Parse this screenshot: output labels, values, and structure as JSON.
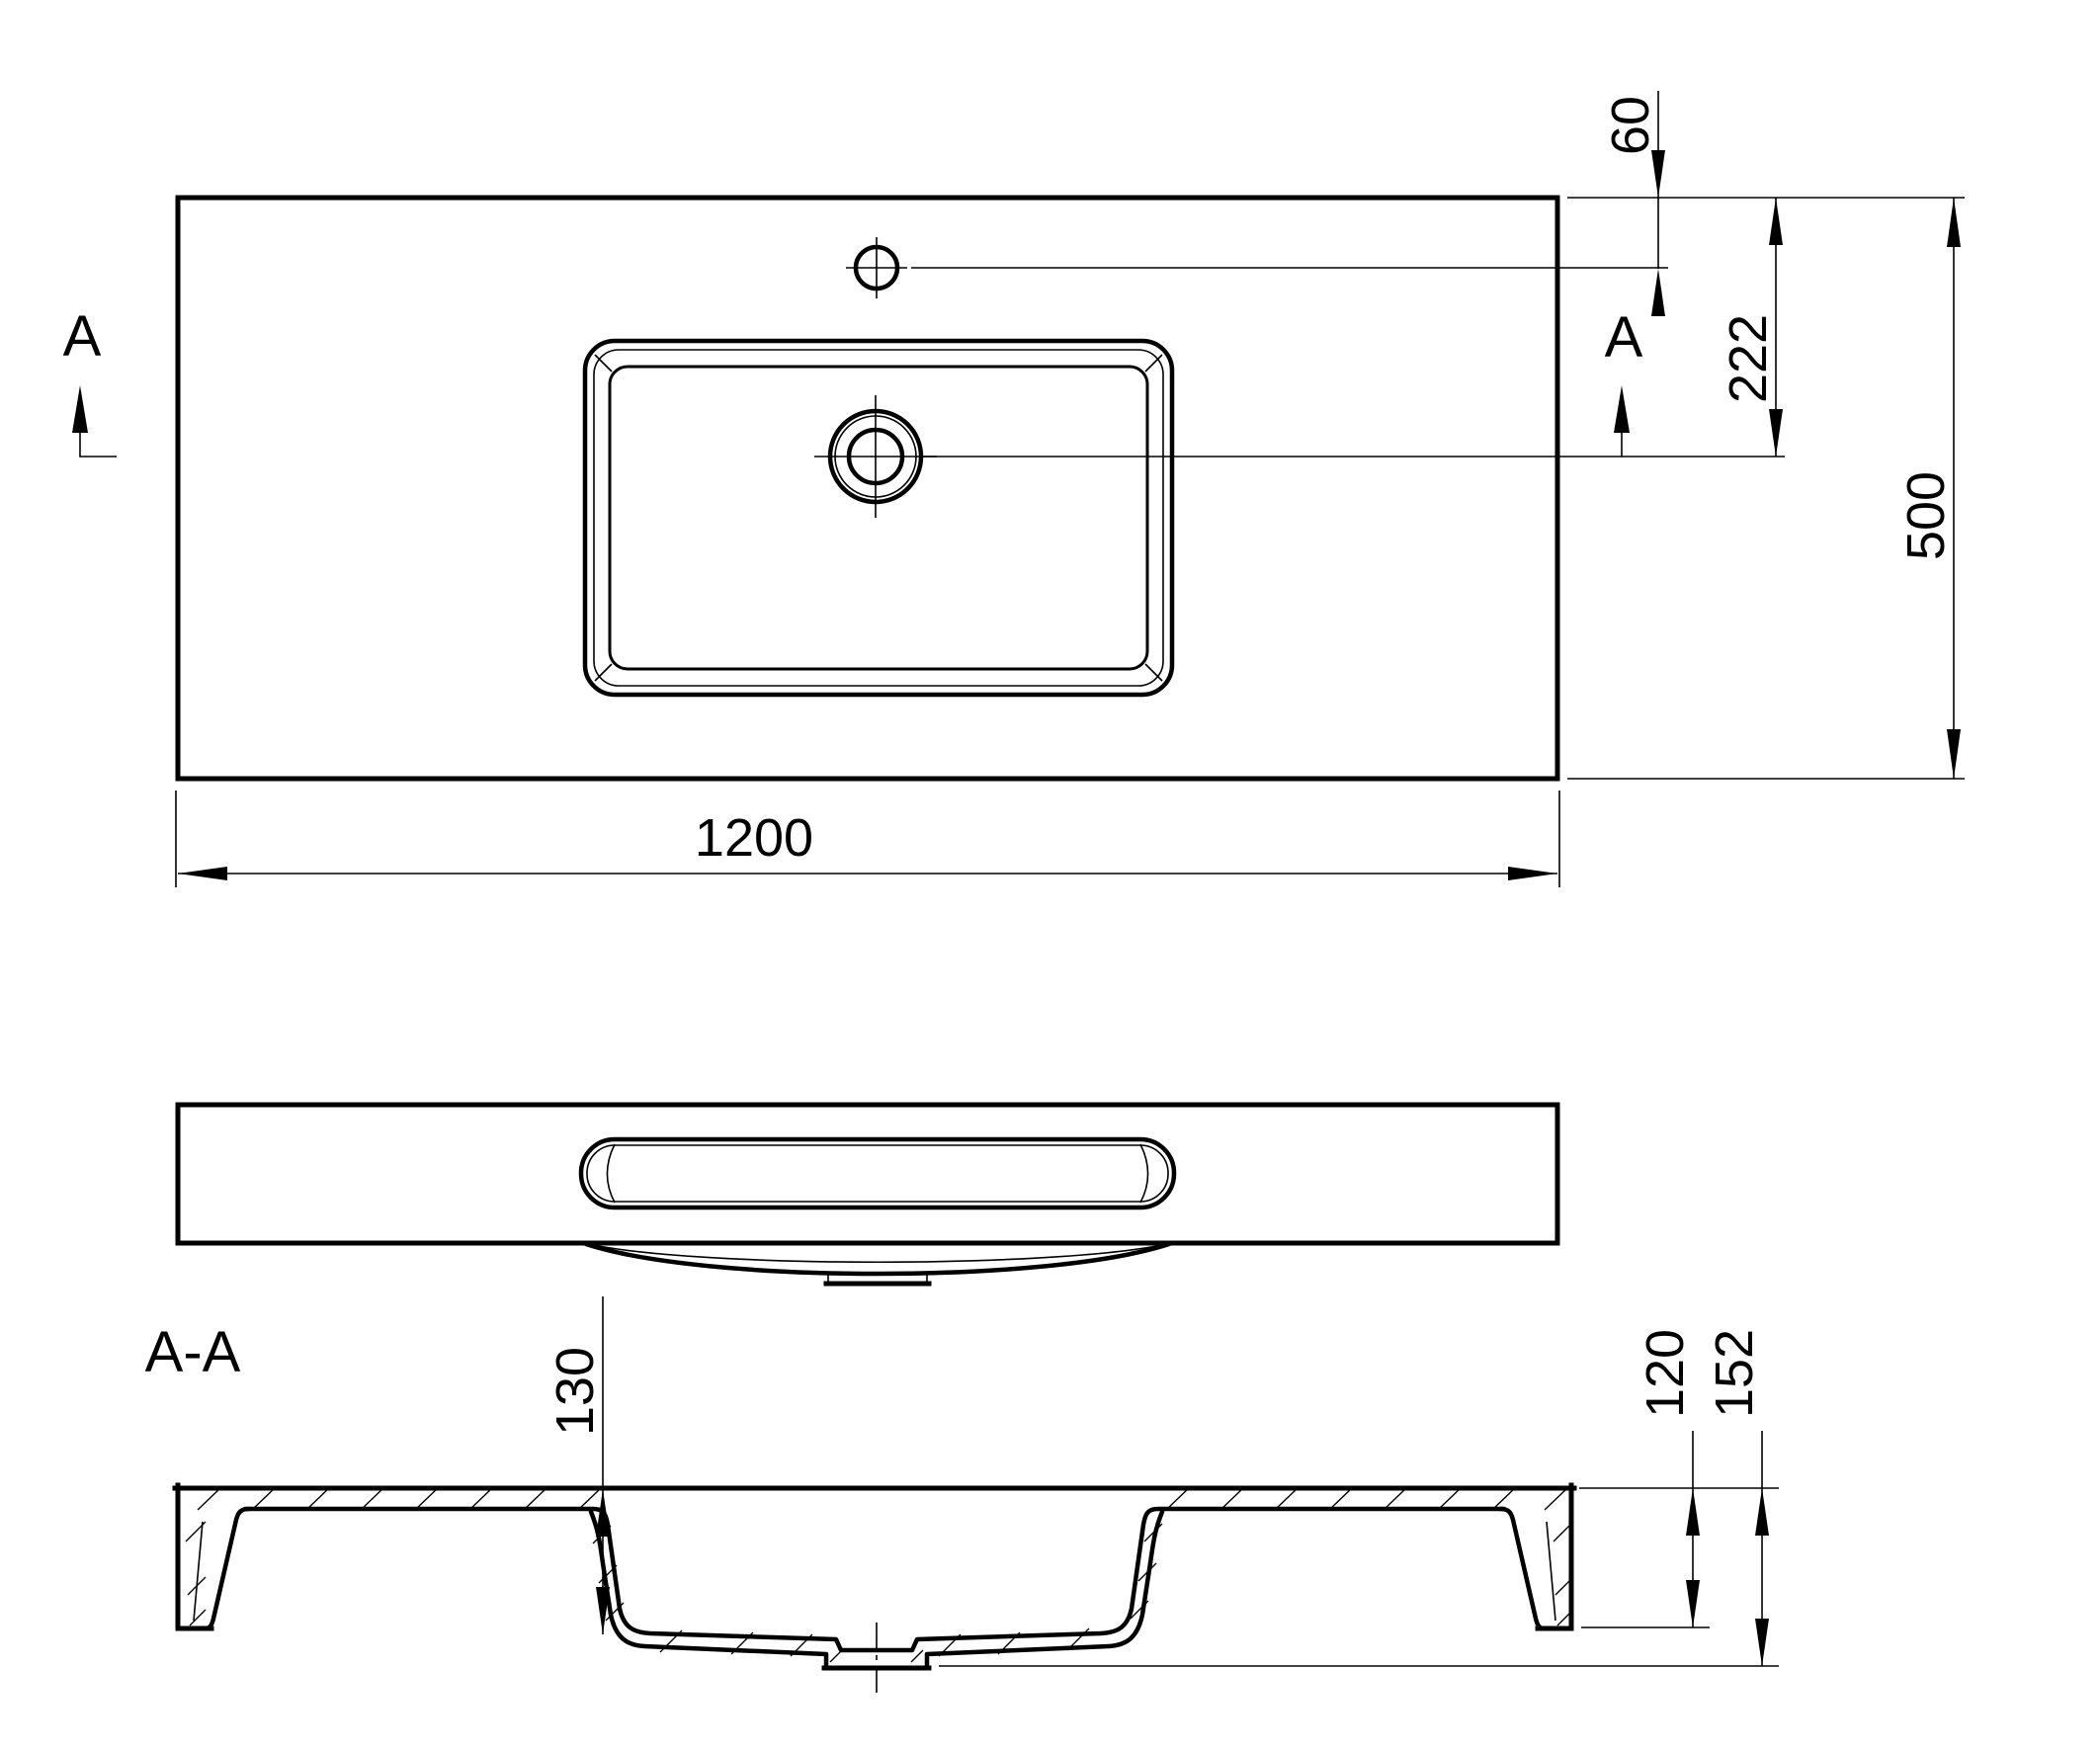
{
  "drawing": {
    "type": "cad-technical-drawing",
    "subject": "rectangular washbasin with countertop",
    "background_color": "#ffffff",
    "line_color": "#000000",
    "labels": {
      "section_mark_left": "A",
      "section_mark_right": "A",
      "section_view_title": "A-A"
    },
    "dimensions": {
      "overall_width": "1200",
      "overall_depth": "500",
      "faucet_hole_offset": "60",
      "drain_center_offset": "222",
      "basin_inner_depth": "130",
      "body_height": "120",
      "overall_height": "152"
    },
    "views": {
      "plan": "top view with faucet hole, basin rim and drain",
      "front": "front elevation with basin opening slot",
      "section": "section A-A through drain centerline"
    }
  }
}
